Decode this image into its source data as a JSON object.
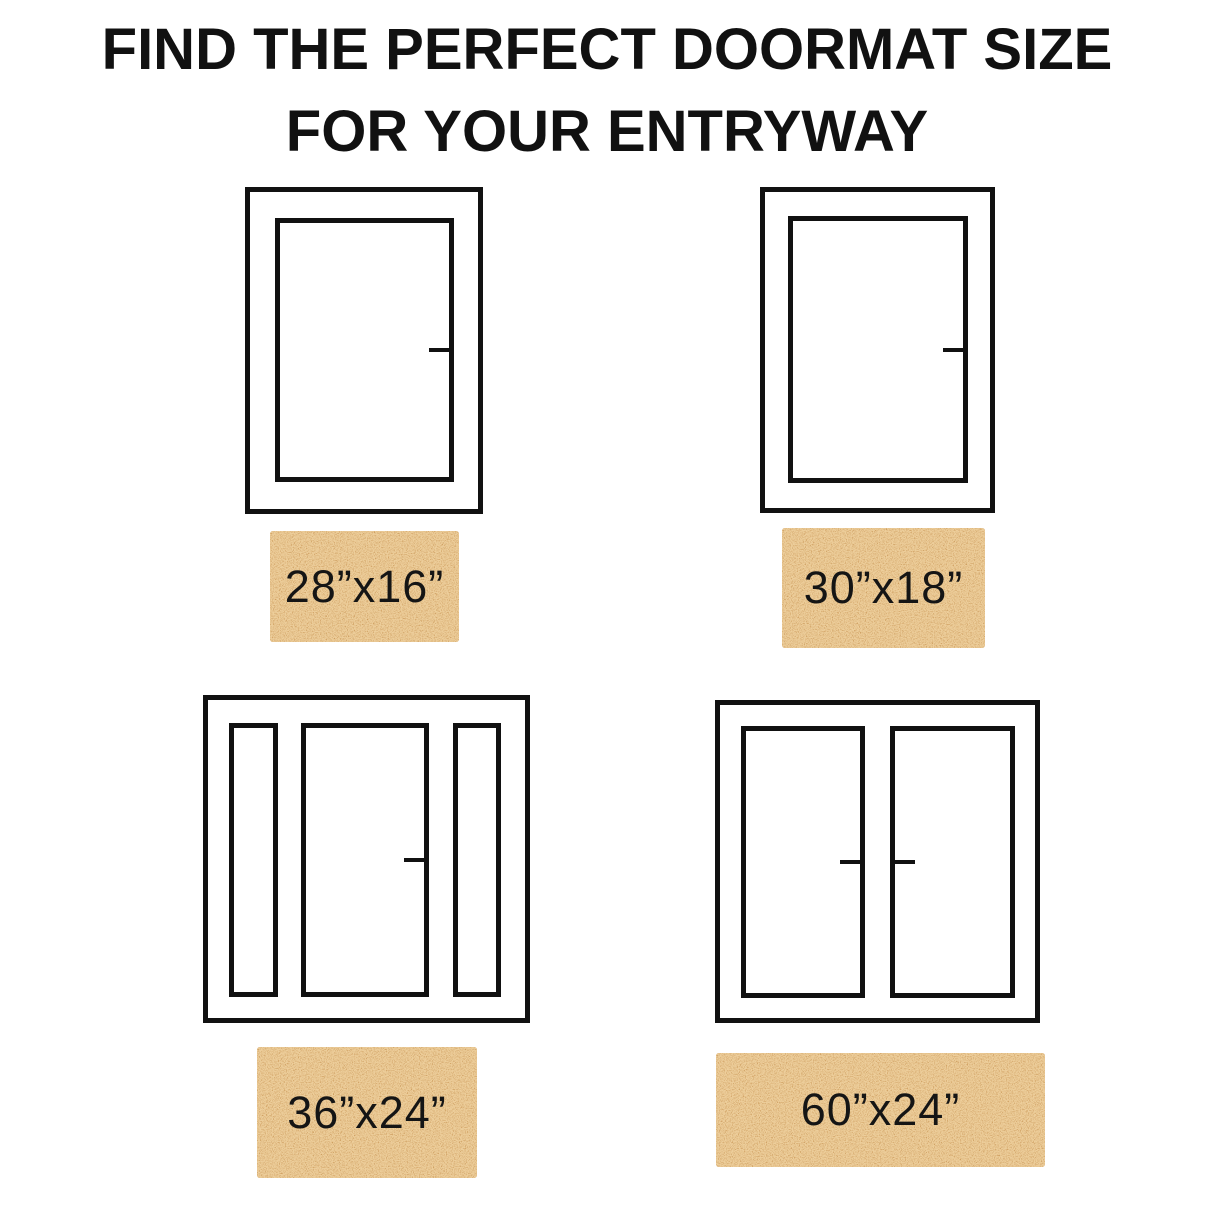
{
  "title": {
    "line1": "FIND THE PERFECT DOORMAT SIZE",
    "line2": "FOR YOUR ENTRYWAY",
    "color": "#111111"
  },
  "colors": {
    "background": "#ffffff",
    "door_line": "#111111",
    "mat_base": "#b97e38",
    "mat_speckle": "#d99e54",
    "mat_text": "#151515"
  },
  "entries": [
    {
      "door_type": "single-door",
      "mat_label": "28”x16”"
    },
    {
      "door_type": "single-door",
      "mat_label": "30”x18”"
    },
    {
      "door_type": "door-with-two-sidelights",
      "mat_label": "36”x24”"
    },
    {
      "door_type": "double-door",
      "mat_label": "60”x24”"
    }
  ]
}
